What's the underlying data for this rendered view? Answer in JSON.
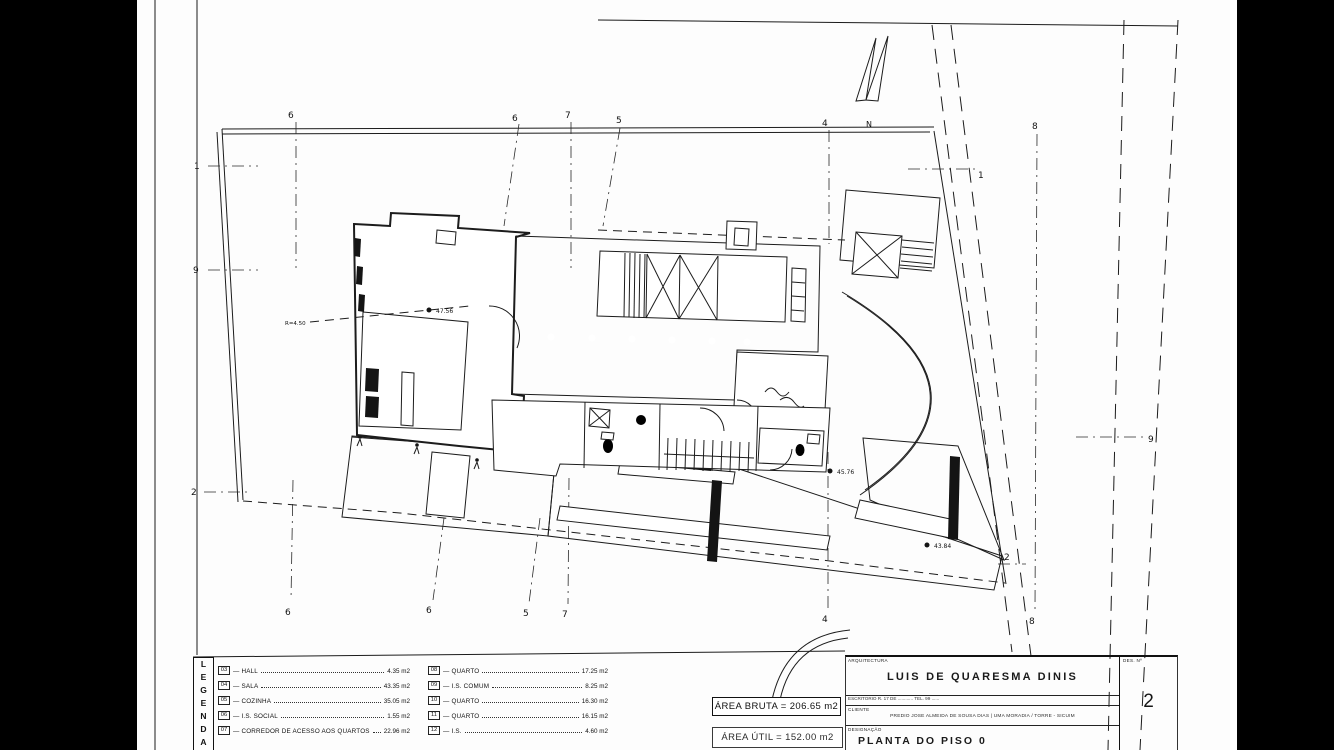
{
  "sheet": {
    "discipline": "ARQUITECTURA",
    "architect": "LUIS DE QUARESMA DINIS",
    "office_line": "ESCRITORIO  R. 17 DE ............  TEL. 99 ......",
    "client_label": "CLIENTE",
    "client_line": "PREDIO JOSE ALMEIDA DE SOUSA DIAS | UMA MORADIA / TORRE - SICUIM",
    "designation_label": "DESIGNAÇÃO",
    "designation": "PLANTA DO PISO 0",
    "sheet_no_label": "DES. Nº",
    "sheet_no": "2"
  },
  "legend": {
    "title": "LEGENDA",
    "col1": [
      {
        "num": "03",
        "name": "HALL",
        "area": "4.35 m2"
      },
      {
        "num": "04",
        "name": "SALA",
        "area": "43.35 m2"
      },
      {
        "num": "05",
        "name": "COZINHA",
        "area": "35.05 m2"
      },
      {
        "num": "06",
        "name": "I.S. SOCIAL",
        "area": "1.55 m2"
      },
      {
        "num": "07",
        "name": "CORREDOR DE ACESSO AOS QUARTOS",
        "area": "22.96 m2"
      }
    ],
    "col2": [
      {
        "num": "08",
        "name": "QUARTO",
        "area": "17.25 m2"
      },
      {
        "num": "09",
        "name": "I.S. COMUM",
        "area": "8.25 m2"
      },
      {
        "num": "10",
        "name": "QUARTO",
        "area": "16.30 m2"
      },
      {
        "num": "11",
        "name": "QUARTO",
        "area": "16.15 m2"
      },
      {
        "num": "12",
        "name": "I.S.",
        "area": "4.60 m2"
      }
    ]
  },
  "areas": {
    "bruta": "ÁREA BRUTA = 206.65 m2",
    "util": "ÁREA ÚTIL = 152.00 m2"
  },
  "plan": {
    "north": "N",
    "markers": {
      "t6a": "6",
      "t6b": "6",
      "t7": "7",
      "t5": "5",
      "t4": "4",
      "t8": "8",
      "l1": "1",
      "l9": "9",
      "l2": "2",
      "r1": "1",
      "r9": "9",
      "r2": "2",
      "b6a": "6",
      "b6b": "6",
      "b5": "5",
      "b7": "7",
      "b4": "4",
      "b8": "8"
    },
    "levels": {
      "garage": "47.56",
      "court": "45.76",
      "terrace": "43.84",
      "radius": "R=4.50"
    }
  }
}
